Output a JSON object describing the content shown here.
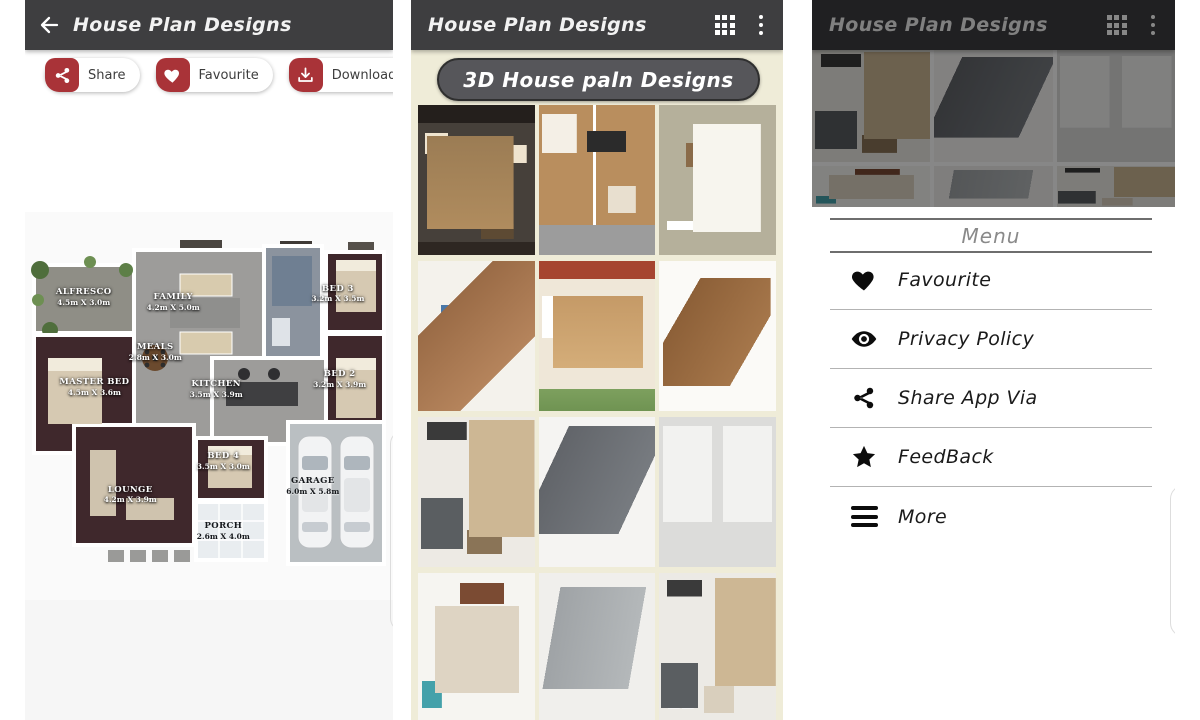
{
  "colors": {
    "accent_red": "#a93338",
    "appbar_bg": "#3e3e40",
    "list_bg": "#efecd8",
    "banner_bg": "#56565a"
  },
  "screen1": {
    "appbar": {
      "title": "House Plan Designs",
      "back_icon": "back-arrow-icon"
    },
    "actions": [
      {
        "label": "Share",
        "icon": "share-icon"
      },
      {
        "label": "Favourite",
        "icon": "heart-icon"
      },
      {
        "label": "Download",
        "icon": "download-icon"
      }
    ],
    "plan": {
      "rooms": [
        {
          "name": "ALFRESCO",
          "dims": "4.5m X 3.0m"
        },
        {
          "name": "FAMILY",
          "dims": "4.2m X 5.0m"
        },
        {
          "name": "BED 3",
          "dims": "3.2m X 3.5m"
        },
        {
          "name": "MEALS",
          "dims": "2.8m X 3.0m"
        },
        {
          "name": "MASTER BED",
          "dims": "4.5m X 3.6m"
        },
        {
          "name": "KITCHEN",
          "dims": "3.5m X 3.9m"
        },
        {
          "name": "BED 2",
          "dims": "3.2m X 3.9m"
        },
        {
          "name": "BED 4",
          "dims": "3.5m X 3.0m"
        },
        {
          "name": "LOUNGE",
          "dims": "4.2m X 3.9m"
        },
        {
          "name": "PORCH",
          "dims": "2.6m X 4.0m"
        },
        {
          "name": "GARAGE",
          "dims": "6.0m X 5.8m"
        }
      ]
    }
  },
  "screen2": {
    "appbar": {
      "title": "House Plan Designs",
      "icons": [
        "grid-icon",
        "overflow-menu-icon"
      ]
    },
    "banner": "3D House paln Designs"
  },
  "screen3": {
    "appbar": {
      "title": "House Plan Designs",
      "icons": [
        "grid-icon",
        "overflow-menu-icon"
      ]
    },
    "menu": {
      "title": "Menu",
      "items": [
        {
          "label": "Favourite",
          "icon": "heart-icon"
        },
        {
          "label": "Privacy Policy",
          "icon": "eye-icon"
        },
        {
          "label": "Share App Via",
          "icon": "share-icon"
        },
        {
          "label": "FeedBack",
          "icon": "star-icon"
        },
        {
          "label": "More",
          "icon": "menu-icon"
        }
      ]
    }
  }
}
